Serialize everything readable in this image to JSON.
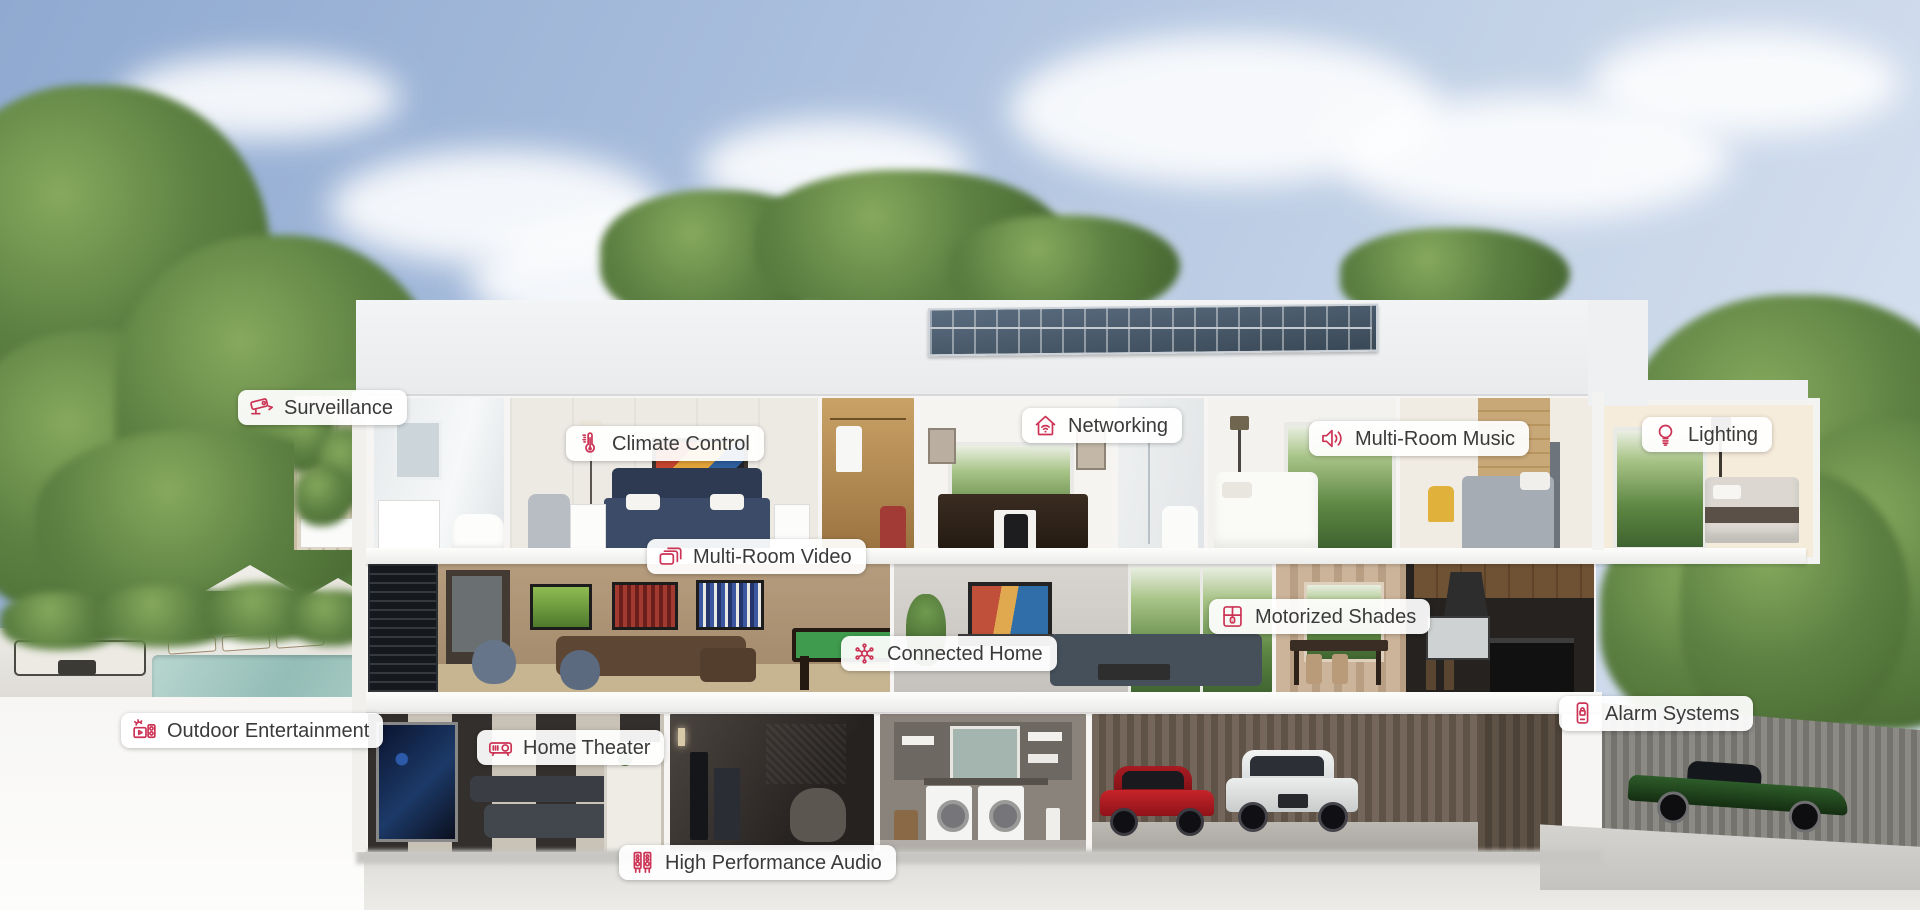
{
  "page": {
    "kind": "smart-home-cutaway-feature-map"
  },
  "colors": {
    "accent": "#cc3355",
    "label_text": "#3a3a3a",
    "label_bg": "#ffffff",
    "sky": "#a9bedd",
    "roof": "#eef0f1",
    "foliage": "#5d8142"
  },
  "hotspots": [
    {
      "label": "Surveillance",
      "icon": "cctv-camera-icon"
    },
    {
      "label": "Climate Control",
      "icon": "thermometer-icon"
    },
    {
      "label": "Networking",
      "icon": "home-wifi-icon"
    },
    {
      "label": "Multi-Room Music",
      "icon": "speaker-icon"
    },
    {
      "label": "Lighting",
      "icon": "lightbulb-icon"
    },
    {
      "label": "Multi-Room Video",
      "icon": "stacked-screens-icon"
    },
    {
      "label": "Connected Home",
      "icon": "network-hub-icon"
    },
    {
      "label": "Motorized Shades",
      "icon": "window-shade-icon"
    },
    {
      "label": "Outdoor Entertainment",
      "icon": "outdoor-tv-speaker-icon"
    },
    {
      "label": "Home Theater",
      "icon": "projector-icon"
    },
    {
      "label": "Alarm Systems",
      "icon": "keypad-lock-icon"
    },
    {
      "label": "High Performance Audio",
      "icon": "tower-speakers-icon"
    }
  ]
}
